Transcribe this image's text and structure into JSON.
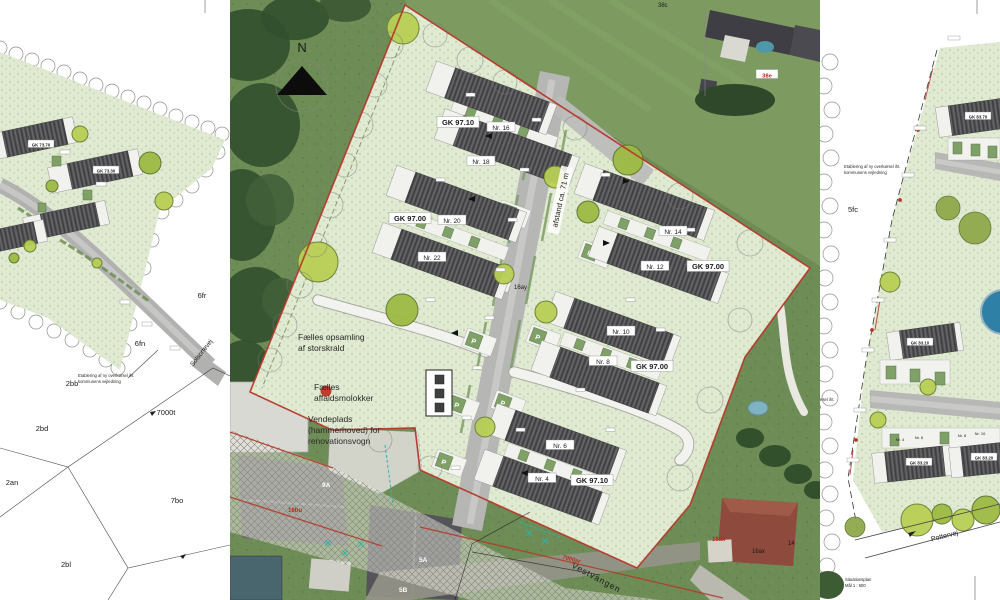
{
  "document": {
    "title_line1": "Situationsplan",
    "title_line2": "Mål 1 : 500"
  },
  "compass": {
    "label": "N"
  },
  "left_panel": {
    "street": "Solsortevej",
    "note_line1": "Etablering af ny overkørsel iht.",
    "note_line2": "kommunens vejledning",
    "parcels": {
      "p6fr": "6fr",
      "p6fn": "6fn",
      "p2bb": "2bb",
      "p7000t": "7000t",
      "p2bd": "2bd",
      "p2an": "2an",
      "p7bo": "7bo",
      "p2bl": "2bl"
    },
    "gk_labels": {
      "b1": "GK 73.70",
      "b2": "GK 73.30"
    }
  },
  "center_panel": {
    "houses": {
      "n4": "Nr. 4",
      "n6": "Nr. 6",
      "n8": "Nr. 8",
      "n10": "Nr. 10",
      "n12": "Nr. 12",
      "n14": "Nr. 14",
      "n16": "Nr. 16",
      "n18": "Nr. 18",
      "n20": "Nr. 20",
      "n22": "Nr. 22"
    },
    "gk": {
      "top": "GK 97.10",
      "west": "GK 97.00",
      "east": "GK 97.00",
      "mid": "GK 97.00",
      "south": "GK 97.10"
    },
    "parking_label": "P",
    "distance_note": "afstand ca. 71 m",
    "waste_note_line1": "Fælles opsamling",
    "waste_note_line2": "af storskrald",
    "molok_note_line1": "Fælles",
    "molok_note_line2": "affaldsmolokker",
    "turning_note_line1": "Vendeplads",
    "turning_note_line2": "(hammerhoved) for",
    "turning_note_line3": "renovationsvogn",
    "street": "Vestvangen",
    "parcel_16ay": "16ay",
    "red_labels": {
      "l7000ar": "7000ar",
      "l16bu": "16bu",
      "l16ax": "16ax",
      "l38e": "38e"
    },
    "black_labels": {
      "l16ax": "16ax",
      "l14": "14",
      "l38c": "38c"
    },
    "house_numbers": {
      "h9a": "9A",
      "h5a": "5A",
      "h5b": "5B"
    }
  },
  "right_panel": {
    "parcel_5fc": "5fc",
    "street": "Pottervej",
    "note_line1": "Etablering af ny overkørsel iht.",
    "note_line2": "kommunens vejledning",
    "gk_labels": {
      "r1": "GK 83.70",
      "r2": "GK 83.10",
      "r3": "GK 83.20",
      "r4": "GK 83.20"
    },
    "houses": {
      "n4": "Nr. 4",
      "n6": "Nr. 6",
      "n8": "Nr. 8",
      "n10": "Nr. 10"
    }
  },
  "colors": {
    "boundary_red": "#b5382a",
    "parcel_green": "#e0e9d1",
    "road_gray": "#b6b6b4",
    "tree_green": "#b8cf55",
    "parking_green": "#7fa066",
    "pond_blue": "#2e80a6"
  }
}
